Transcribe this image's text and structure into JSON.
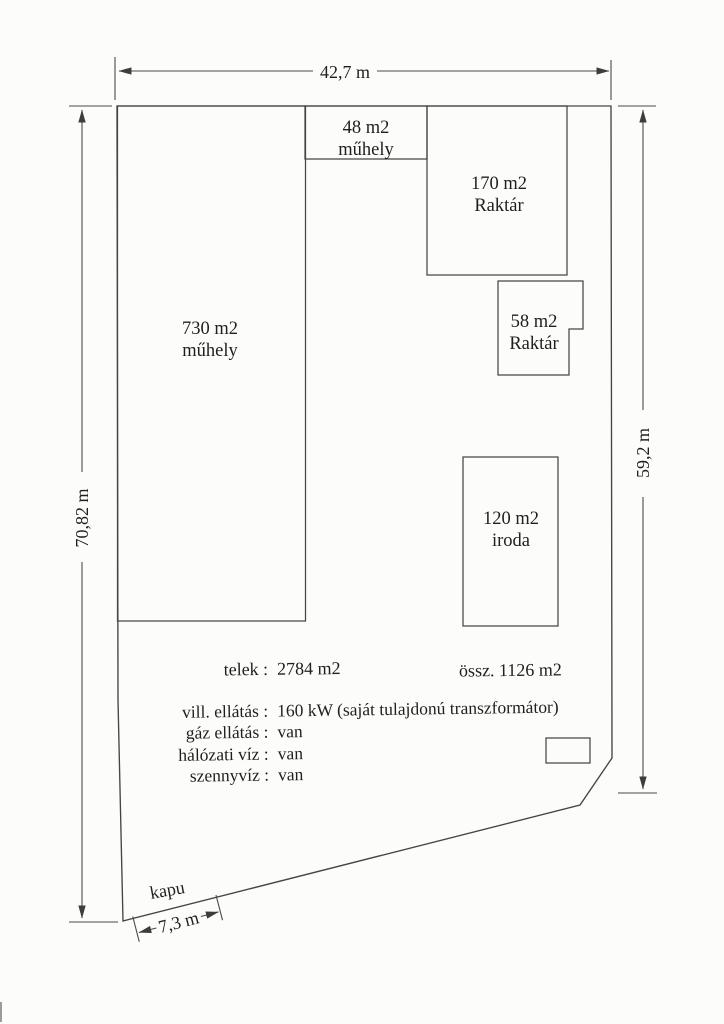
{
  "dimensions": {
    "top_width": "42,7 m",
    "left_height": "70,82 m",
    "right_height": "59,2 m",
    "gate_width": "7,3 m"
  },
  "buildings": [
    {
      "area": "730 m2",
      "use": "műhely"
    },
    {
      "area": "48 m2",
      "use": "műhely"
    },
    {
      "area": "170 m2",
      "use": "Raktár"
    },
    {
      "area": "58 m2",
      "use": "Raktár"
    },
    {
      "area": "120 m2",
      "use": "iroda"
    }
  ],
  "gate_label": "kapu",
  "info": {
    "plot_label": "telek :",
    "plot_value": "2784 m2",
    "total_area": "össz. 1126 m2",
    "utilities": [
      {
        "label": "vill. ellátás :",
        "value": "160 kW (saját tulajdonú transzformátor)"
      },
      {
        "label": "gáz ellátás :",
        "value": "van"
      },
      {
        "label": "hálózati víz :",
        "value": "van"
      },
      {
        "label": "szennyvíz :",
        "value": "van"
      }
    ]
  },
  "colors": {
    "ink": "#1f1f1f",
    "line": "#454545",
    "paper": "#fcfcfb"
  }
}
